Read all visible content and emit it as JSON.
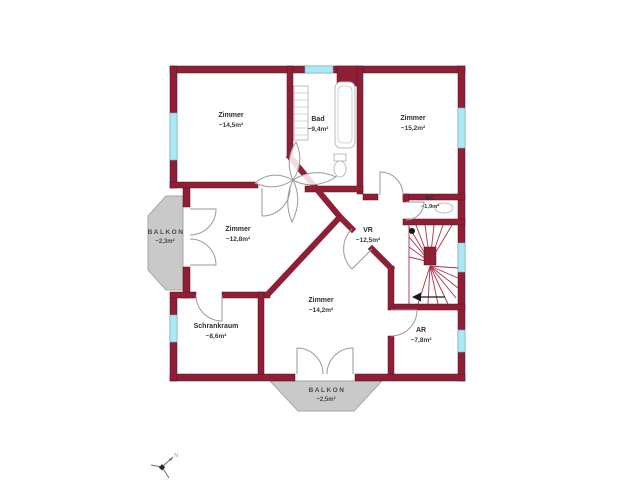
{
  "plan": {
    "rooms": [
      {
        "id": "zimmer-nw",
        "name": "Zimmer",
        "area": "~14,5m²"
      },
      {
        "id": "bad",
        "name": "Bad",
        "area": "~9,4m²"
      },
      {
        "id": "zimmer-ne",
        "name": "Zimmer",
        "area": "~15,2m²"
      },
      {
        "id": "wc",
        "name": "WC",
        "area": "~1,9m²"
      },
      {
        "id": "vr",
        "name": "VR",
        "area": "~12,5m²"
      },
      {
        "id": "zimmer-w",
        "name": "Zimmer",
        "area": "~12,8m²"
      },
      {
        "id": "schrankraum",
        "name": "Schrankraum",
        "area": "~8,6m²"
      },
      {
        "id": "zimmer-s",
        "name": "Zimmer",
        "area": "~14,2m²"
      },
      {
        "id": "ar",
        "name": "AR",
        "area": "~7,8m²"
      },
      {
        "id": "balkon-west",
        "name": "BALKON",
        "area": "~2,3m²"
      },
      {
        "id": "balkon-sued",
        "name": "BALKON",
        "area": "~2,5m²"
      }
    ],
    "compass": {
      "north_label": "N"
    },
    "colors": {
      "wall": "#8E1F36",
      "window": "#ACE7F2",
      "balcony": "#C9C9C9",
      "label_text": "#2E2E2E",
      "background": "#FFFFFF"
    }
  }
}
